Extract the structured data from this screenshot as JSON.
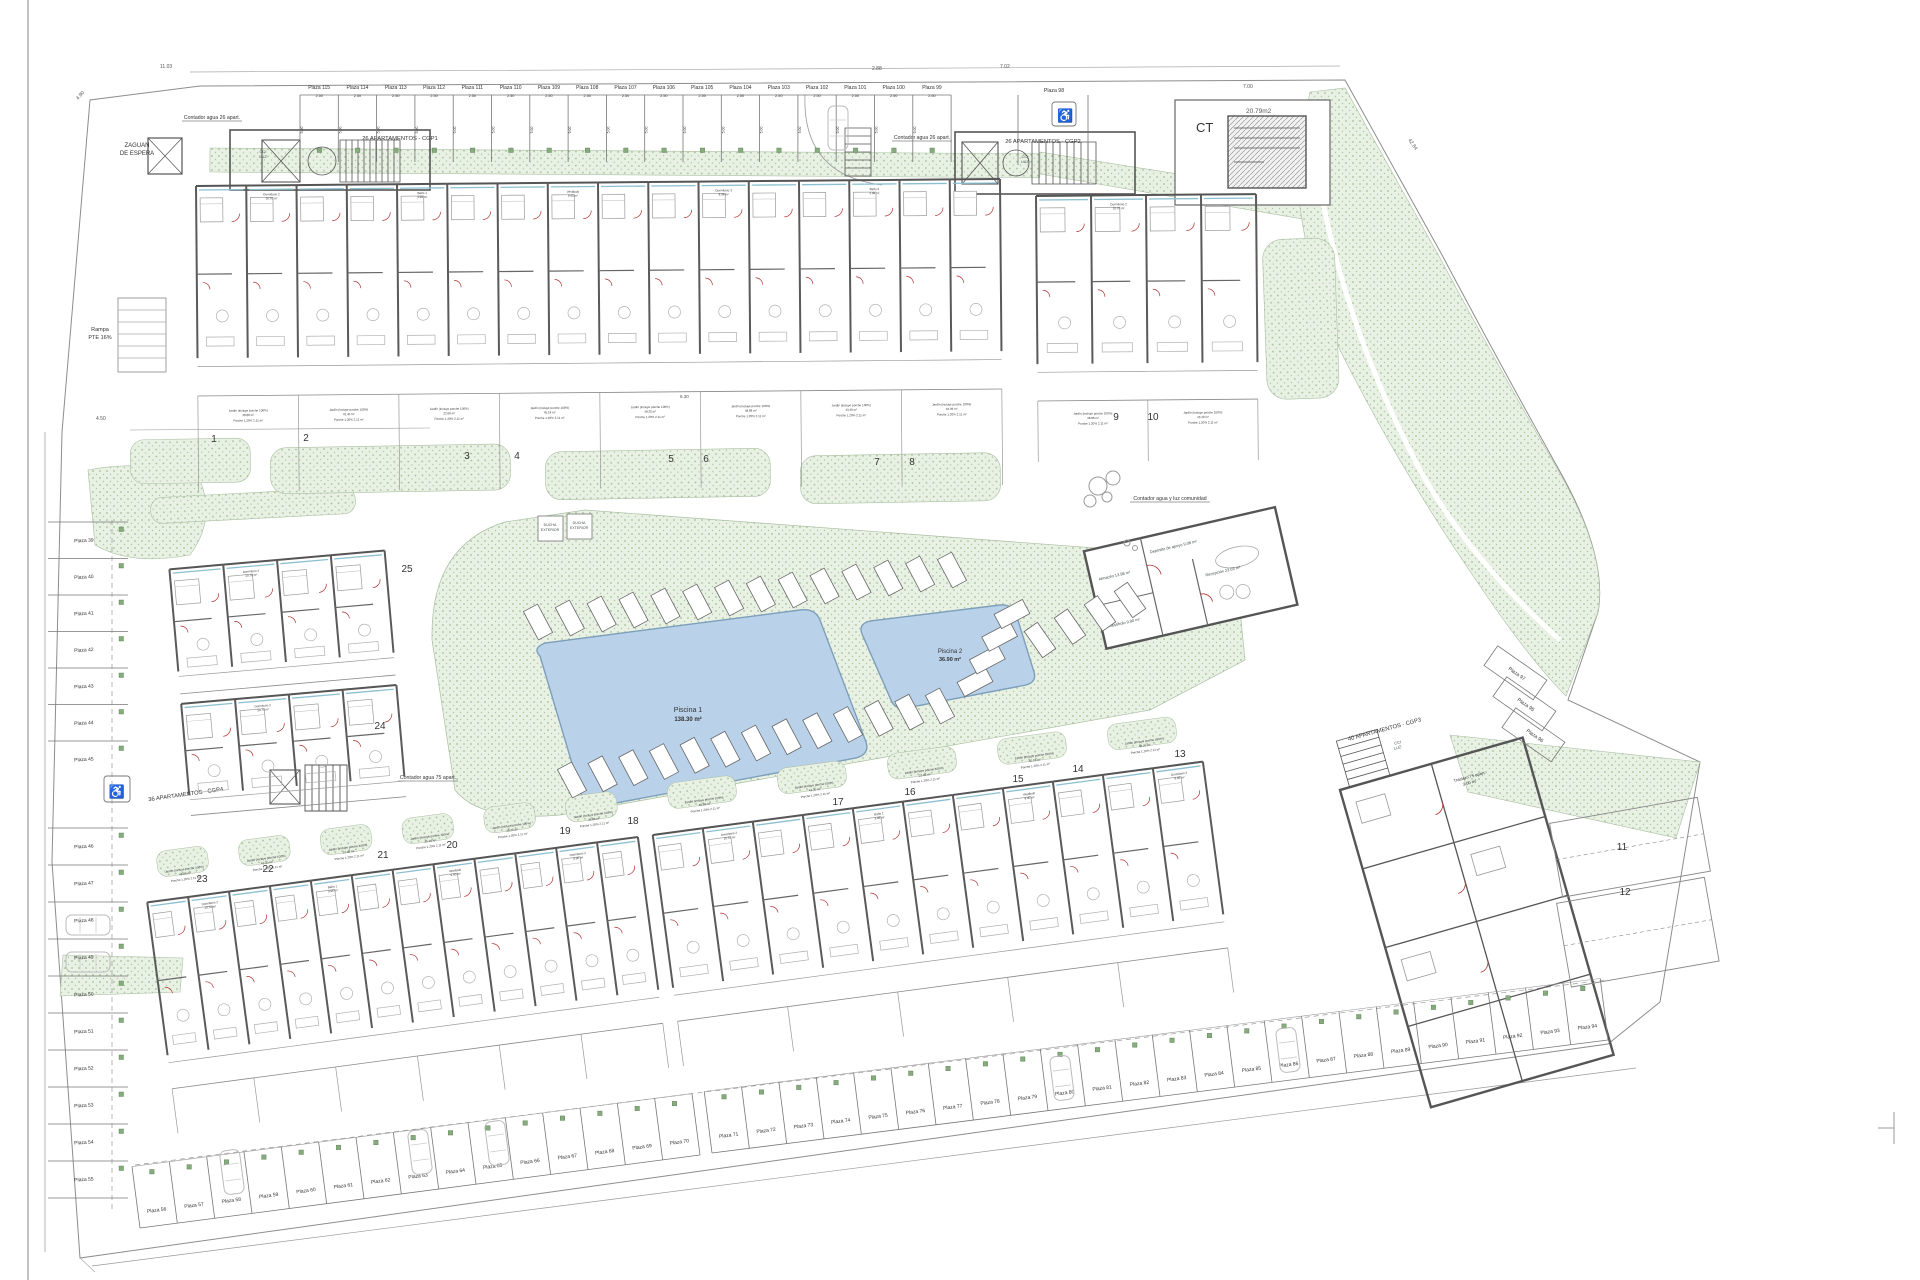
{
  "plan": {
    "blocks": {
      "cgp1": "26 APARTAMENTOS - CGP1",
      "cgp2": "26 APARTAMENTOS - CGP2",
      "cgp3": "40 APARTAMENTOS - CGP3",
      "cgp4": "36 APARTAMENTOS - CGP4"
    },
    "meters": {
      "m26a": "Contador agua 26 apart.",
      "m26b": "Contador agua 26 apart.",
      "mcom": "Contador agua y luz comunidad",
      "m75": "Contador agua 75 apart."
    },
    "ct": {
      "label": "CT",
      "area": "20.79m2"
    },
    "zaguan": {
      "line1": "ZAGUAN",
      "line2": "DE ESPERA"
    },
    "rampa": {
      "line1": "Rampa",
      "line2": "PTE 16%"
    },
    "cci": {
      "line1": "CCI",
      "line2": "LUZ"
    },
    "ducha": {
      "line1": "DUCHA",
      "line2": "EXTERIOR"
    },
    "trastero": {
      "line1": "Trastero 75 apart.",
      "line2": "3.00 m²"
    },
    "pools": [
      {
        "name": "Piscina 1",
        "area": "138.30 m²"
      },
      {
        "name": "Piscina 2",
        "area": "36.90 m²"
      }
    ],
    "plots": {
      "top": [
        "1",
        "2",
        "3",
        "4",
        "5",
        "6",
        "7",
        "8"
      ],
      "top_right": [
        "9",
        "10"
      ],
      "mid_left": [
        "25",
        "24"
      ],
      "bottom_left": [
        "23",
        "22",
        "21",
        "20",
        "19",
        "18"
      ],
      "bottom_mid": [
        "17",
        "16",
        "15",
        "14",
        "13"
      ],
      "right": [
        "11",
        "12"
      ]
    },
    "parking": {
      "top": [
        "Plaza 115",
        "Plaza 114",
        "Plaza 113",
        "Plaza 112",
        "Plaza 111",
        "Plaza 110",
        "Plaza 109",
        "Plaza 108",
        "Plaza 107",
        "Plaza 106",
        "Plaza 105",
        "Plaza 104",
        "Plaza 103",
        "Plaza 102",
        "Plaza 101",
        "Plaza 100",
        "Plaza 99"
      ],
      "top_right": "Plaza 98",
      "left": [
        "Plaza 39",
        "Plaza 40",
        "Plaza 41",
        "Plaza 42",
        "Plaza 43",
        "Plaza 44",
        "Plaza 45",
        "Plaza 46",
        "Plaza 47",
        "Plaza 48",
        "Plaza 49",
        "Plaza 50",
        "Plaza 51",
        "Plaza 52",
        "Plaza 53",
        "Plaza 54",
        "Plaza 55"
      ],
      "bottom": [
        "Plaza 56",
        "Plaza 57",
        "Plaza 58",
        "Plaza 59",
        "Plaza 60",
        "Plaza 61",
        "Plaza 62",
        "Plaza 63",
        "Plaza 64",
        "Plaza 65",
        "Plaza 66",
        "Plaza 67",
        "Plaza 68",
        "Plaza 69",
        "Plaza 70",
        "Plaza 71",
        "Plaza 72",
        "Plaza 73",
        "Plaza 74",
        "Plaza 75",
        "Plaza 76",
        "Plaza 77",
        "Plaza 78",
        "Plaza 79",
        "Plaza 80",
        "Plaza 81",
        "Plaza 82",
        "Plaza 83",
        "Plaza 84",
        "Plaza 85",
        "Plaza 86",
        "Plaza 87",
        "Plaza 88",
        "Plaza 89",
        "Plaza 90",
        "Plaza 91",
        "Plaza 92",
        "Plaza 93",
        "Plaza 94"
      ],
      "right_stack": [
        "Plaza 97",
        "Plaza 95",
        "Plaza 96"
      ]
    },
    "rooms": [
      {
        "name": "Dormitorio 1",
        "area": "11.50 m²"
      },
      {
        "name": "Dormitorio 2",
        "area": "10.70 m²"
      },
      {
        "name": "Dormitorio 3",
        "area": "8.96 m²"
      },
      {
        "name": "Salón Comedor Cocina",
        "area": "23.80 m²"
      },
      {
        "name": "Baño 1",
        "area": "3.96 m²"
      },
      {
        "name": "Baño 2",
        "area": "3.96 m²"
      },
      {
        "name": "Paso",
        "area": "4.60 m²"
      },
      {
        "name": "Vestíbulo",
        "area": "9.90 m²"
      }
    ],
    "communal_rooms": [
      {
        "name": "Almacén",
        "area": "13.98 m²"
      },
      {
        "name": "Recepción",
        "area": "23.65 m²"
      },
      {
        "name": "Depósito de apoyo",
        "area": "9.08 m²"
      },
      {
        "name": "Vestíbulo",
        "area": "9.90 m²"
      }
    ],
    "garden": {
      "jardin": "Jardín (incluye porche 100%)",
      "jardin_areas": [
        "48.88 m²",
        "43.40 m²",
        "22.06 m²",
        "45.18 m²",
        "48.25 m²"
      ],
      "porche1": "Porche 1.20%",
      "porche1_area": "2.11 m²",
      "porche2": "Porche 2.20%",
      "porche2_area": "4.06 m²"
    },
    "dims": {
      "d1": "11.03",
      "d2": "2.88",
      "d3": "7.02",
      "d4": "7.00",
      "d5": "42.84",
      "d6": "4.90",
      "d7": "2.50",
      "d8": "5.00",
      "d9": "6.30",
      "d10": "4.50"
    }
  }
}
